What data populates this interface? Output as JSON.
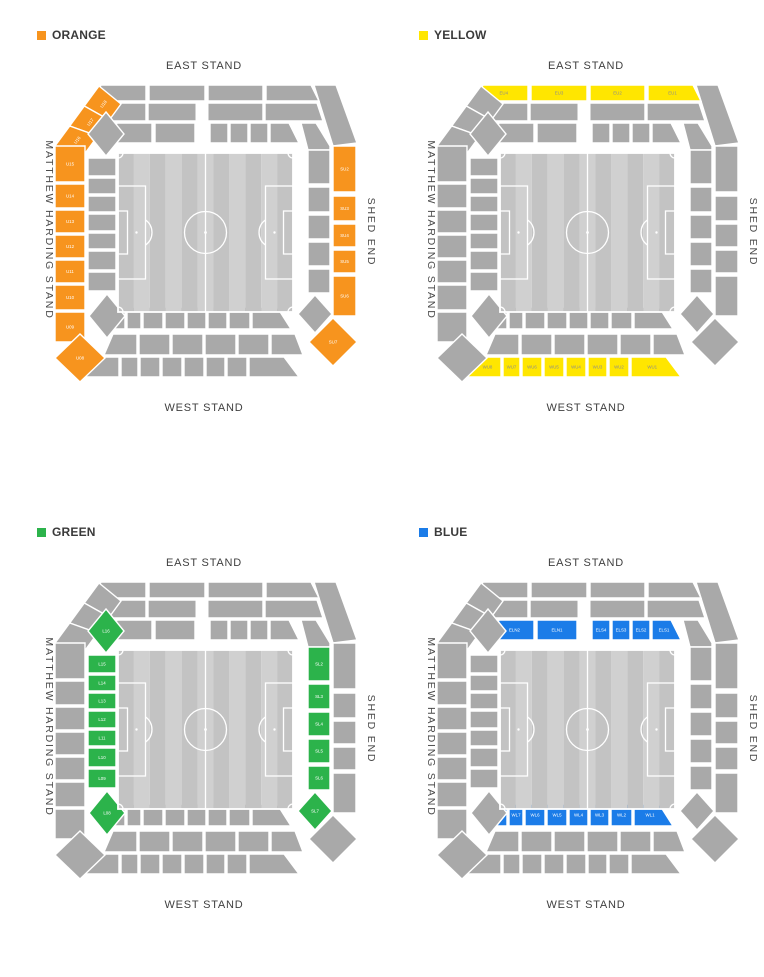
{
  "stands": {
    "east": "EAST STAND",
    "west": "WEST STAND",
    "matthew_harding": "MATTHEW HARDING STAND",
    "shed_end": "SHED END"
  },
  "colors": {
    "section_gray": "#A9A9A9",
    "pitch_stripe_light": "#D0D0D0",
    "pitch_stripe_dark": "#C3C3C3",
    "pitch_lines": "#FFFFFF",
    "stand_label": "#3F3F3F",
    "legend_text": "#3A3A3A"
  },
  "maps": [
    {
      "id": "orange",
      "legend": "ORANGE",
      "color": "#F7941E",
      "label_color": "#FFFFFF",
      "sections": {
        "ATL1": "U18",
        "ATL2": "U17",
        "ATL3": "U16",
        "AL1": "U15",
        "AL2": "U14",
        "AL3": "U13",
        "AL4": "U12",
        "AL5": "U11",
        "AL6": "U10",
        "AL7": "U09",
        "ABL": "U08",
        "AR1": "SU2",
        "AR2": "SU3",
        "AR3": "SU4",
        "AR4": "SU5",
        "AR5": "SU6",
        "ABR": "SU7"
      }
    },
    {
      "id": "yellow",
      "legend": "YELLOW",
      "color": "#FFE600",
      "label_color": "#8C8C8C",
      "sections": {
        "AT1": "EU4",
        "AT2": "EU3",
        "AT3": "EU2",
        "AT4": "EU1",
        "AB1": "WU8",
        "AB2": "WU7",
        "AB3": "WU6",
        "AB4": "WU5",
        "AB5": "WU4",
        "AB6": "WU3",
        "AB7": "WU2",
        "AB8": "WU1"
      }
    },
    {
      "id": "green",
      "legend": "GREEN",
      "color": "#2CB34B",
      "label_color": "#FFFFFF",
      "sections": {
        "CTL": "L16",
        "CL1": "L15",
        "CL2": "L14",
        "CL3": "L13",
        "CL4": "L12",
        "CL5": "L11",
        "CL6": "L10",
        "CL7": "L09",
        "CBL": "L08",
        "CR1": "SL2",
        "CR2": "SL3",
        "CR3": "SL4",
        "CR4": "SL5",
        "CR5": "SL6",
        "CBR": "SL7"
      }
    },
    {
      "id": "blue",
      "legend": "BLUE",
      "color": "#1B7CE8",
      "label_color": "#FFFFFF",
      "sections": {
        "CT1": "ELN2",
        "CT2": "ELN1",
        "CT3": "ELS4",
        "CT4": "ELS3",
        "CT5": "ELS2",
        "CT6": "ELS1",
        "CB1": "WL8",
        "CB2": "WL7",
        "CB3": "WL6",
        "CB4": "WL5",
        "CB5": "WL4",
        "CB6": "WL3",
        "CB7": "WL2",
        "CB8": "WL1"
      }
    }
  ]
}
